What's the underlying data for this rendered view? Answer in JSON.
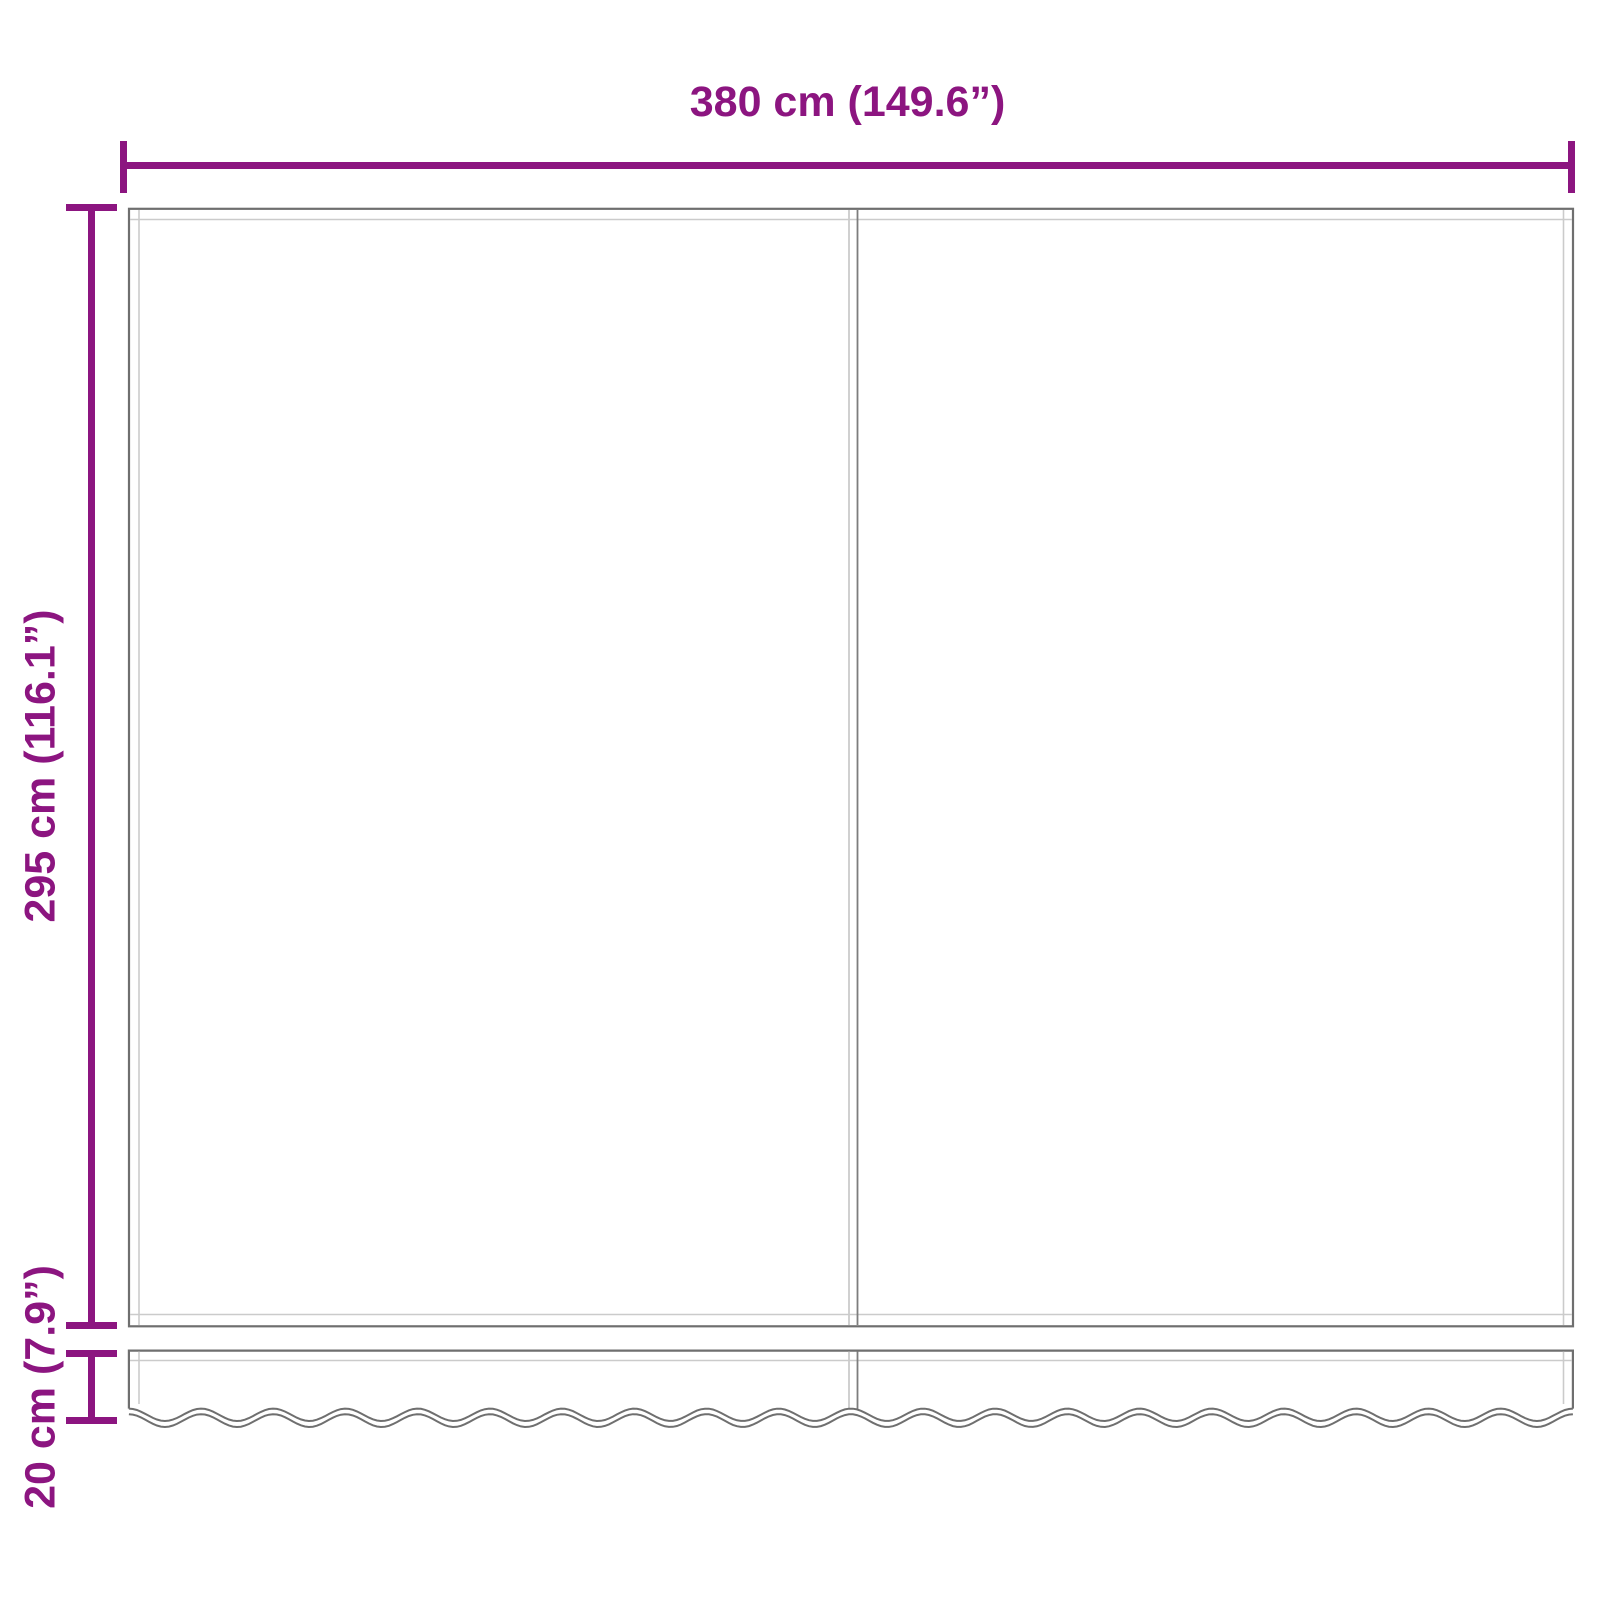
{
  "diagram": {
    "labels": {
      "width": "380 cm (149.6”)",
      "height": "295 cm (116.1”)",
      "valance_height": "20 cm (7.9”)"
    },
    "measurements": {
      "width_cm": 380,
      "width_in": 149.6,
      "height_cm": 295,
      "height_in": 116.1,
      "valance_cm": 20,
      "valance_in": 7.9
    },
    "colors": {
      "accent": "#8C1580",
      "outline": "#6F6F6F",
      "stitch": "#CBCBCB",
      "seam": "#7D7D7D",
      "background": "#FFFFFF"
    }
  }
}
